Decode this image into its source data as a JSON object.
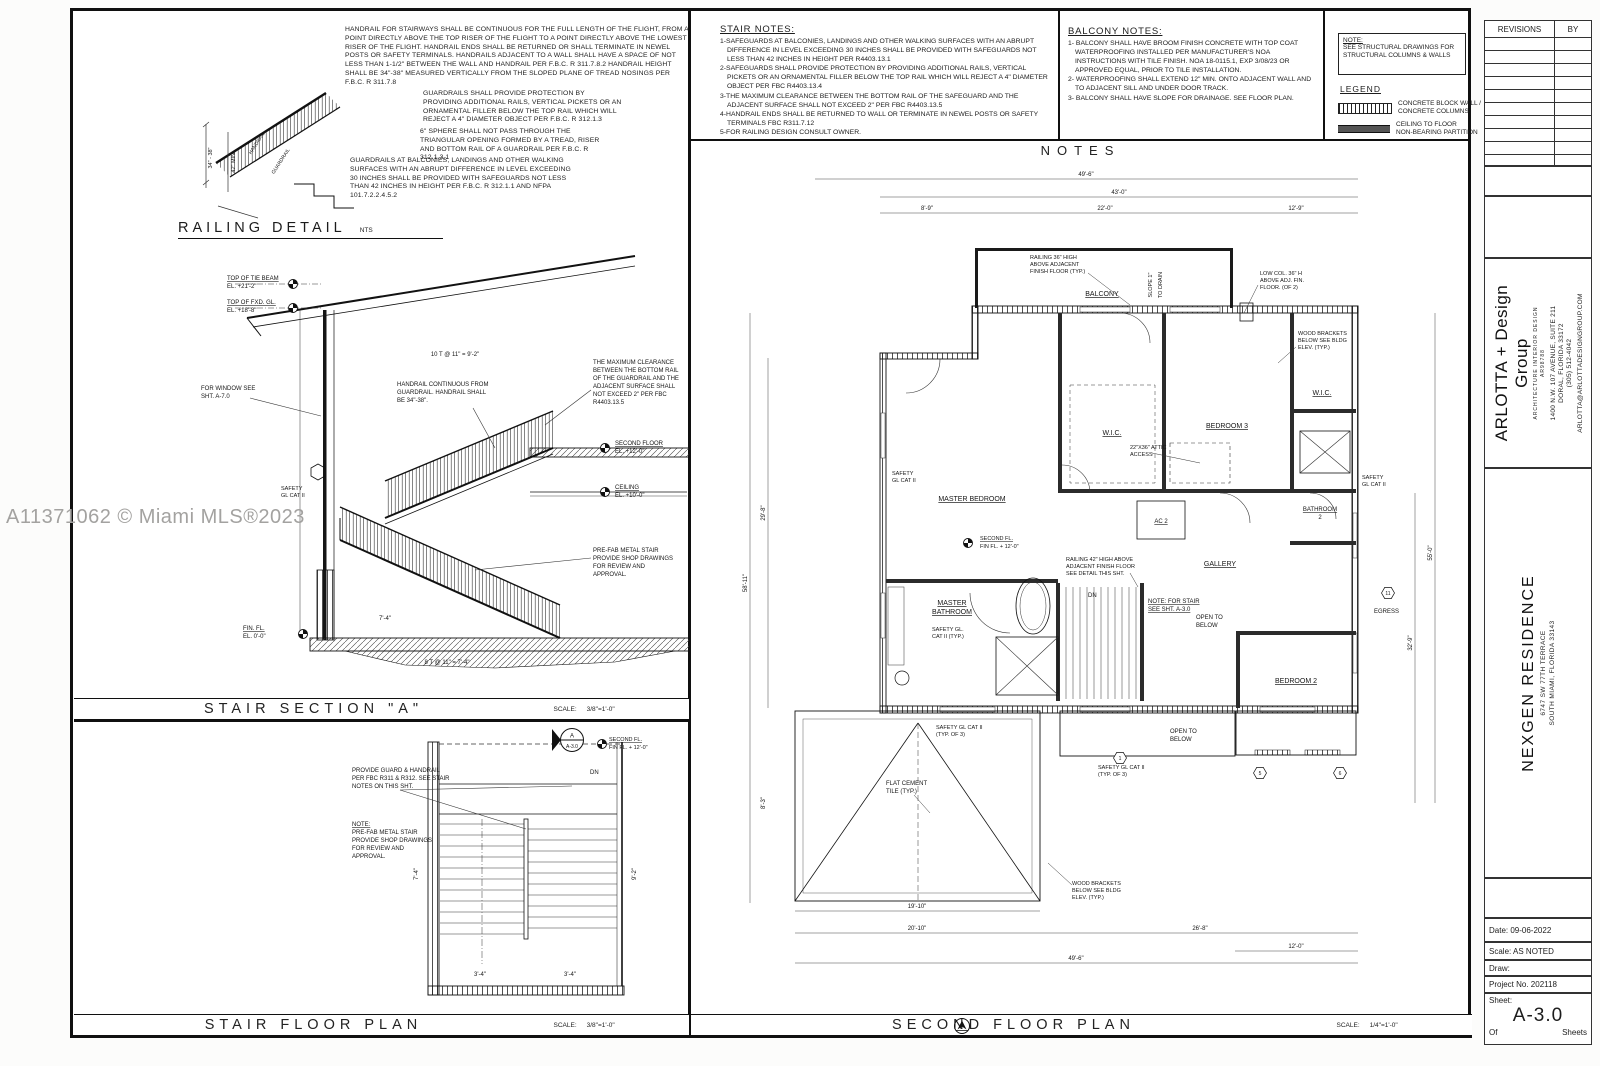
{
  "watermark": "A11371062 © Miami MLS®2023",
  "handrail_notes": {
    "n1": "HANDRAIL FOR STAIRWAYS SHALL BE CONTINUOUS FOR THE FULL LENGTH OF THE FLIGHT, FROM A POINT DIRECTLY ABOVE THE TOP RISER OF THE FLIGHT TO A POINT DIRECTLY ABOVE THE LOWEST RISER OF THE FLIGHT. HANDRAIL ENDS SHALL BE RETURNED OR SHALL TERMINATE IN NEWEL POSTS OR SAFETY TERMINALS. HANDRAILS ADJACENT TO A WALL SHALL HAVE A SPACE OF NOT LESS THAN 1-1/2\" BETWEEN THE WALL AND HANDRAIL PER F.B.C. R 311.7.8.2  HANDRAIL HEIGHT SHALL BE 34\"-38\" MEASURED VERTICALLY FROM THE SLOPED PLANE OF TREAD NOSINGS PER F.B.C. R 311.7.8",
    "n2": "GUARDRAILS SHALL PROVIDE PROTECTION BY PROVIDING ADDITIONAL RAILS, VERTICAL PICKETS OR AN ORNAMENTAL FILLER BELOW THE TOP RAIL WHICH WILL REJECT A 4\" DIAMETER OBJECT PER F.B.C. R 312.1.3",
    "n3": "6\" SPHERE SHALL NOT PASS THROUGH THE TRIANGULAR OPENING FORMED BY A TREAD, RISER AND BOTTOM RAIL OF A GUARDRAIL PER F.B.C. R 312.1.3.1",
    "n4": "GUARDRAILS AT BALCONIES, LANDINGS AND OTHER WALKING SURFACES WITH AN ABRUPT DIFFERENCE IN LEVEL EXCEEDING 30 INCHES SHALL BE PROVIDED WITH SAFEGUARDS NOT LESS THAN 42 INCHES IN HEIGHT PER F.B.C. R 312.1.1 AND NFPA 101.7.2.2.4.5.2"
  },
  "railing_detail": {
    "title": "RAILING DETAIL",
    "scale": "NTS",
    "handrail": "HANDRAIL",
    "guardrail": "GUARDRAIL",
    "dim_height": "34\" - 38\"",
    "dim_min": "42\" MIN."
  },
  "stair_section": {
    "title": "STAIR SECTION \"A\"",
    "scale_label": "SCALE:",
    "scale": "3/8\"=1'-0\"",
    "tie_beam": [
      "TOP OF TIE BEAM",
      "EL. +21'-2\""
    ],
    "fxd_gl": [
      "TOP OF FXD. GL.",
      "EL. +18'-8\""
    ],
    "window_note": [
      "FOR WINDOW SEE",
      "SHT. A-7.0"
    ],
    "handrail_note": [
      "HANDRAIL CONTINUOUS FROM",
      "GUARDRAIL. HANDRAIL SHALL",
      "BE 34\"-38\"."
    ],
    "clearance_note": [
      "THE MAXIMUM CLEARANCE",
      "BETWEEN THE BOTTOM RAIL",
      "OF THE GUARDRAIL AND THE",
      "ADJACENT SURFACE SHALL",
      "NOT EXCEED 2\" PER FBC",
      "R4403.13.5"
    ],
    "second_floor": [
      "SECOND FLOOR",
      "EL. +12'-0\""
    ],
    "ceiling": [
      "CEILING",
      "EL. +10'-0\""
    ],
    "prefab_note": [
      "PRE-FAB METAL STAIR",
      "PROVIDE SHOP DRAWINGS",
      "FOR REVIEW AND",
      "APPROVAL."
    ],
    "safety": [
      "SAFETY",
      "GL CAT II"
    ],
    "fin_fl": [
      "FIN. FL.",
      "EL. 0'-0\""
    ],
    "dim_top": "10 T @ 11\" = 9'-2\"",
    "dim_bottom": "8 T @ 11\" = 7'-4\"",
    "dim_run": "7'-4\""
  },
  "stair_plan": {
    "title": "STAIR FLOOR PLAN",
    "scale_label": "SCALE:",
    "scale": "3/8\"=1'-0\"",
    "guard_note": [
      "PROVIDE GUARD & HANDRAIL",
      "PER FBC R311 & R312. SEE STAIR",
      "NOTES ON THIS SHT."
    ],
    "prefab_note": [
      "NOTE:",
      "PRE-FAB METAL STAIR",
      "PROVIDE SHOP DRAWINGS",
      "FOR REVIEW AND",
      "APPROVAL."
    ],
    "section_marker_top": "A",
    "section_marker_bottom": "A-3.0",
    "second_fl": [
      "SECOND FL.",
      "FIN FL. + 12'-0\""
    ],
    "dn": "DN",
    "dims": [
      "7'-4\"",
      "3'-4\"",
      "3'-4\"",
      "9'-2\""
    ]
  },
  "stair_notes": {
    "title": "STAIR NOTES:",
    "items": [
      "1-SAFEGUARDS  AT BALCONIES, LANDINGS AND OTHER WALKING SURFACES WITH AN ABRUPT DIFFERENCE IN LEVEL EXCEEDING 30 INCHES SHALL BE PROVIDED WITH SAFEGUARDS NOT LESS THAN 42 INCHES IN HEIGHT PER R4403.13.1",
      "2-SAFEGUARDS SHALL PROVIDE PROTECTION BY PROVIDING ADDITIONAL RAILS, VERTICAL PICKETS OR AN ORNAMENTAL FILLER BELOW THE TOP RAIL WHICH WILL REJECT A 4\" DIAMETER OBJECT PER FBC R4403.13.4",
      "3-THE MAXIMUM CLEARANCE BETWEEN THE BOTTOM RAIL OF THE SAFEGUARD AND THE ADJACENT SURFACE SHALL NOT EXCEED 2\" PER FBC R4403.13.5",
      "4-HANDRAIL ENDS SHALL BE RETURNED TO WALL OR TERMINATE IN NEWEL POSTS OR SAFETY TERMINALS FBC R311.7.12",
      "5-FOR RAILING DESIGN CONSULT OWNER."
    ]
  },
  "balcony_notes": {
    "title": "BALCONY NOTES:",
    "items": [
      "1- BALCONY SHALL HAVE BROOM FINISH CONCRETE WITH TOP COAT WATERPROOFING INSTALLED PER MANUFACTURER'S NOA INSTRUCTIONS WITH TILE FINISH. NOA 18-0115.1, EXP 3/08/23 OR APPROVED EQUAL, PRIOR TO TILE INSTALLATION.",
      "2- WATERPROOFING SHALL EXTEND 12\" MIN. ONTO ADJACENT WALL AND TO ADJACENT SILL AND UNDER DOOR TRACK.",
      "3- BALCONY SHALL HAVE SLOPE FOR DRAINAGE. SEE FLOOR PLAN."
    ]
  },
  "legend": {
    "note_title": "NOTE:",
    "note_body": "SEE STRUCTURAL DRAWINGS FOR STRUCTURAL COLUMNS & WALLS",
    "title": "LEGEND",
    "block_wall": [
      "CONCRETE BLOCK WALL /",
      "CONCRETE COLUMNS"
    ],
    "partition": [
      "CEILING TO FLOOR",
      "NON-BEARING PARTITION"
    ]
  },
  "notes_title": "NOTES",
  "floor_plan": {
    "title": "SECOND FLOOR PLAN",
    "scale_label": "SCALE:",
    "scale": "1/4\"=1'-0\"",
    "rooms": {
      "balcony": "BALCONY",
      "master_bedroom": "MASTER BEDROOM",
      "wic": "W.I.C.",
      "bedroom3": "BEDROOM 3",
      "bathroom2": [
        "BATHROOM",
        "2"
      ],
      "ac2": "AC 2",
      "gallery": "GALLERY",
      "master_bathroom": [
        "MASTER",
        "BATHROOM"
      ],
      "bedroom2": "BEDROOM 2",
      "egress": "EGRESS",
      "open_below": [
        "OPEN TO",
        "BELOW"
      ]
    },
    "second_fl": [
      "SECOND FL.",
      "FIN FL. + 12'-0\""
    ],
    "attic": [
      "22\"X36\" ATTIC",
      "ACCESS"
    ],
    "railing36": [
      "RAILING 36\" HIGH",
      "ABOVE ADJACENT",
      "FINISH FLOOR (TYP.)"
    ],
    "slope": [
      "SLOPE 1\"",
      "TO DRAIN"
    ],
    "lowcol": [
      "LOW COL. 36\" H",
      "ABOVE ADJ. FIN.",
      "FLOOR. (OF 2)"
    ],
    "wood_brackets": [
      "WOOD BRACKETS",
      "BELOW SEE BLDG",
      "ELEV. (TYP.)"
    ],
    "railing42": [
      "RAILING 42\" HIGH ABOVE",
      "ADJACENT FINISH FLOOR",
      "SEE DETAIL THIS SHT."
    ],
    "stair_note": [
      "NOTE: FOR STAIR",
      "SEE SHT. A-3.0"
    ],
    "flat_tile": [
      "FLAT CEMENT",
      "TILE (TYP.)"
    ],
    "safety": [
      "SAFETY",
      "GL CAT II"
    ],
    "safety3": [
      "SAFETY GL CAT II",
      "(TYP. OF 3)"
    ],
    "safety_typ": [
      "SAFETY GL.",
      "CAT II (TYP.)"
    ],
    "dn": "DN",
    "dims_top": [
      "49'-6\"",
      "43'-0\"",
      "8'-9\"",
      "22'-0\"",
      "12'-9\""
    ],
    "dims_bottom": [
      "19'-10\"",
      "20'-10\"",
      "26'-8\"",
      "49'-6\"",
      "12'-0\""
    ],
    "dims_left": [
      "58'-11\"",
      "29'-8\"",
      "8'-3\""
    ],
    "dims_right": [
      "55'-0\"",
      "32'-9\""
    ],
    "markers": [
      "1",
      "5",
      "6",
      "11"
    ]
  },
  "titleblock": {
    "revisions": "REVISIONS",
    "by": "BY",
    "firm": {
      "name": "ARLOTTA + Design Group",
      "tag1": "ARCHITECTURE  INTERIOR DESIGN",
      "tag2": "AR98788",
      "addr1": "1400 N.W. 107 AVENUE, SUITE 211",
      "addr2": "DORAL, FLORIDA 33172",
      "phone": "(305) 512-4042",
      "email": "ARLOTTA@ARLOTTADESIGNGROUP.COM"
    },
    "project": {
      "name": "NEXGEN RESIDENCE",
      "addr1": "6747 SW 77TH TERRACE",
      "addr2": "SOUTH MIAMI, FLORIDA 33143"
    },
    "date": "Date: 09-06-2022",
    "scale": "Scale: AS NOTED",
    "draw": "Draw:",
    "project_no": "Project No. 202118",
    "sheet_label": "Sheet:",
    "sheet": "A-3.0",
    "of": "Of",
    "sheets": "Sheets"
  }
}
